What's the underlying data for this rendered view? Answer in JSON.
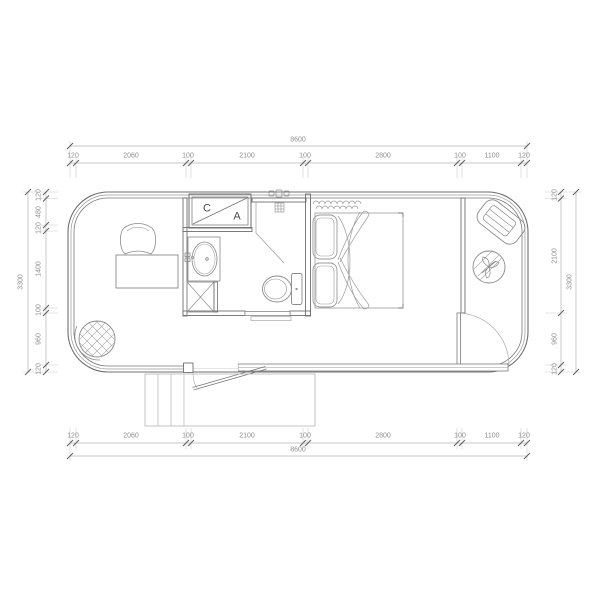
{
  "drawing": {
    "room_labels": {
      "c": "C",
      "a": "A"
    }
  },
  "dimensions": {
    "top": {
      "overall": "8600",
      "segments": [
        "120",
        "2060",
        "100",
        "2100",
        "100",
        "2800",
        "100",
        "1100",
        "120"
      ]
    },
    "bottom": {
      "overall": "8600",
      "segments": [
        "120",
        "2060",
        "100",
        "2100",
        "100",
        "2800",
        "100",
        "1100",
        "120"
      ]
    },
    "left": {
      "overall": "3300",
      "segments": [
        "120",
        "480",
        "120",
        "1400",
        "100",
        "960",
        "120"
      ]
    },
    "right": {
      "overall": "3300",
      "segments": [
        "120",
        "2100",
        "960",
        "120"
      ]
    }
  },
  "colors": {
    "wall_line": "#6f6f6f",
    "furniture_line": "#8a8a8a",
    "dimension_line": "#b5b5b5",
    "dimension_text": "#8f8f8f",
    "background": "#ffffff"
  }
}
